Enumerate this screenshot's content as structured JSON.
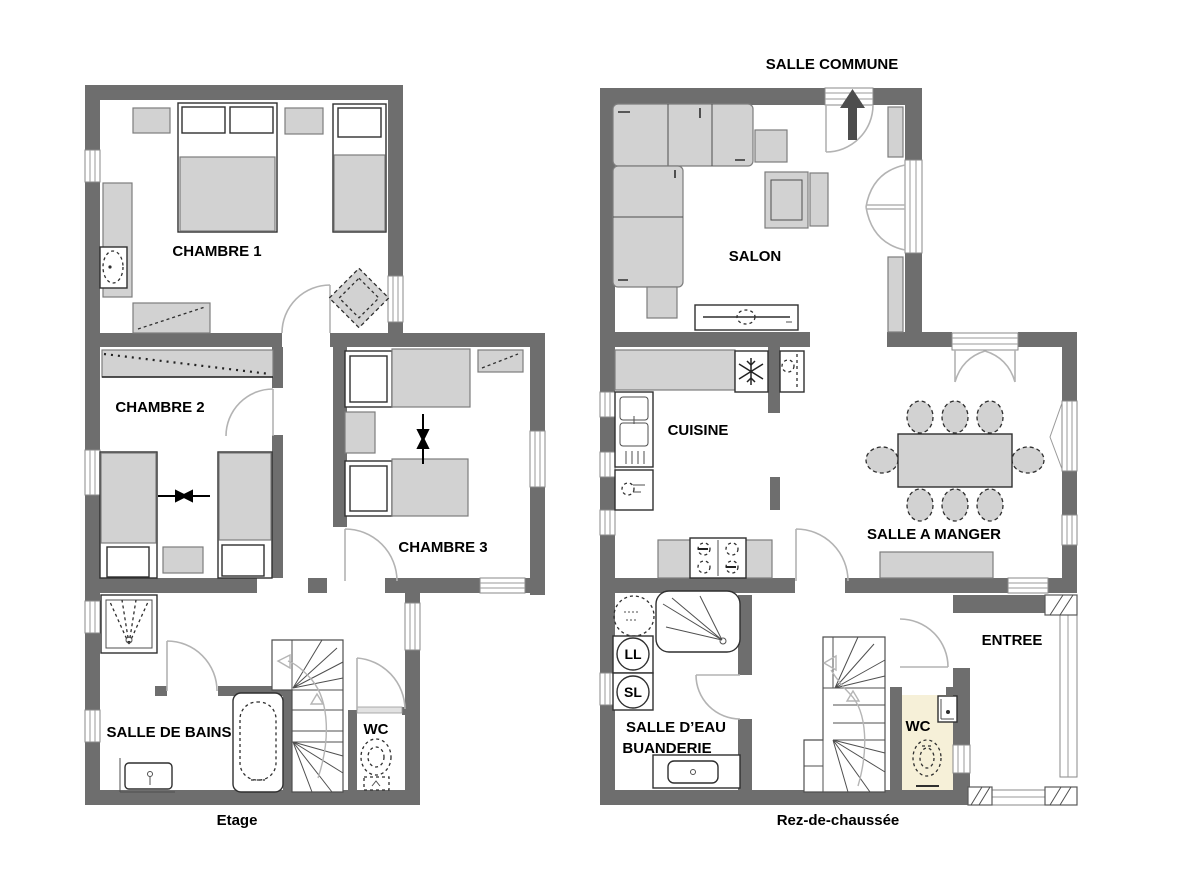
{
  "etage": {
    "title": "Etage",
    "chambre1": "CHAMBRE 1",
    "chambre2": "CHAMBRE 2",
    "chambre3": "CHAMBRE 3",
    "salle_de_bains": "SALLE DE BAINS",
    "wc": "WC"
  },
  "rdc": {
    "title": "Rez-de-chaussée",
    "salle_commune": "SALLE COMMUNE",
    "salon": "SALON",
    "cuisine": "CUISINE",
    "salle_a_manger": "SALLE A MANGER",
    "salle_deau_1": "SALLE D’EAU",
    "salle_deau_2": "BUANDERIE",
    "wc": "WC",
    "entree": "ENTREE",
    "lave_linge": "LL",
    "seche_linge": "SL"
  },
  "colors": {
    "wall": "#6e6e6e",
    "furniture": "#d2d2d2",
    "wc_floor": "#f6f0d8",
    "arrow": "#4d4d4d"
  }
}
